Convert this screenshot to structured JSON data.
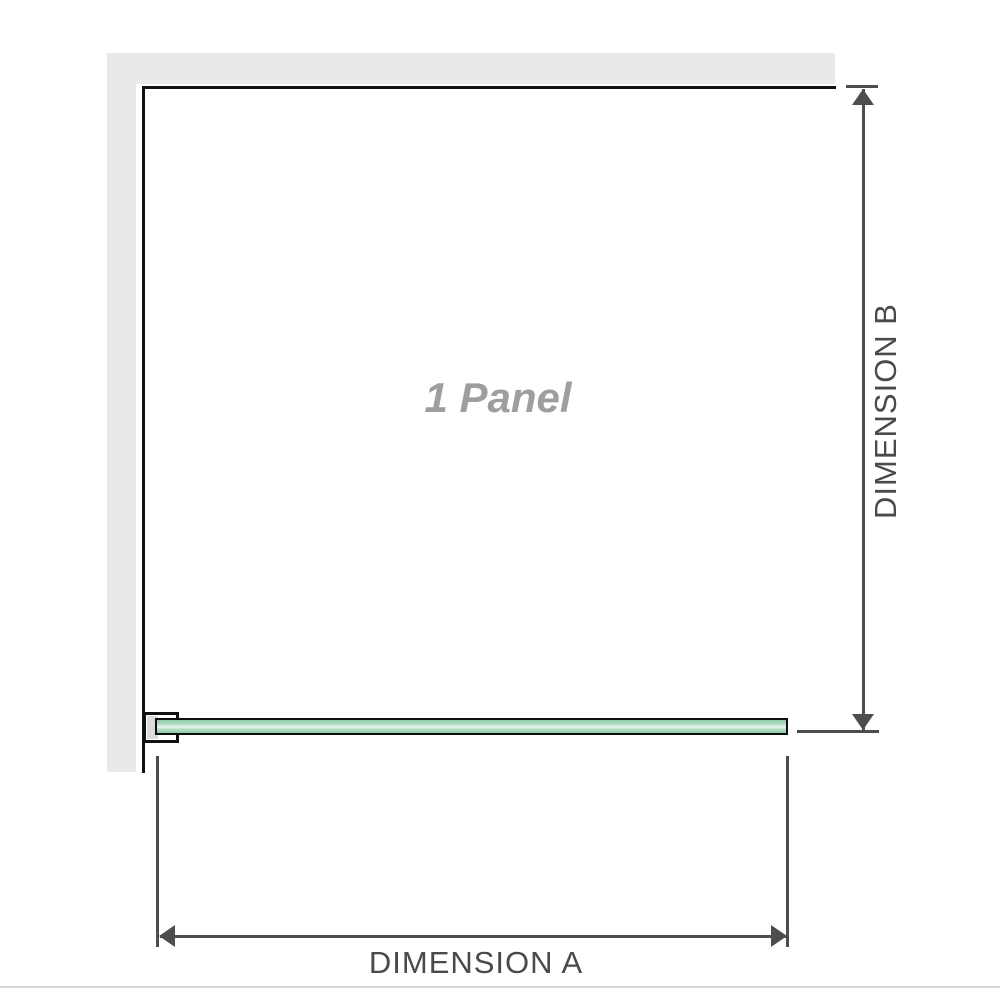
{
  "labels": {
    "panel": "1 Panel",
    "dimension_a": "DIMENSION A",
    "dimension_b": "DIMENSION B"
  },
  "colors": {
    "background": "#ffffff",
    "wall": "#e9e9e9",
    "frame_outline": "#111111",
    "dimension_lines": "#4d4d4d",
    "dimension_text": "#4a4a4a",
    "panel_label_text": "#9e9e9e",
    "glass_edge": "#93cead",
    "glass_center": "#e9f7ee",
    "bracket_pad": "#dcdcdc",
    "photo_edge_line": "#dcd8d3"
  }
}
